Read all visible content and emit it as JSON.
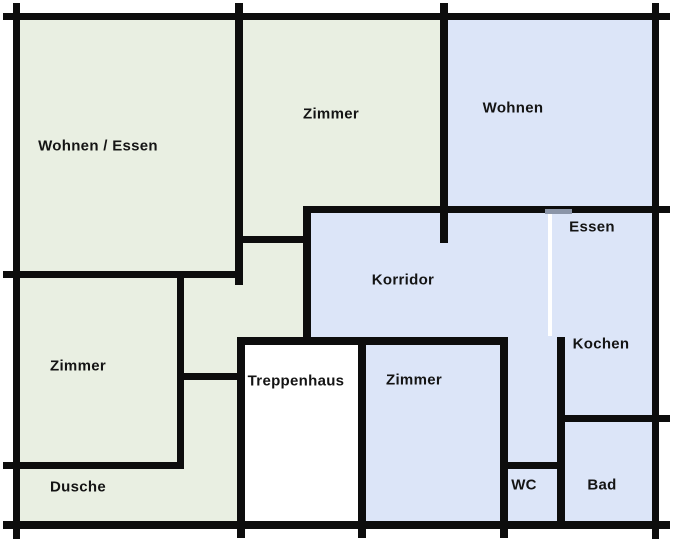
{
  "title": "Grundriss / floor plan",
  "colors": {
    "wall": "#0d0d0d",
    "apartment_green": "#e9efe2",
    "apartment_blue": "#dce5f8",
    "stairwell_white": "#ffffff",
    "door_gap_gray": "#8b95a8",
    "door_gap_white": "#ffffff",
    "label_text": "#141414",
    "page_background": "#ffffff"
  },
  "rooms": [
    {
      "id": "wohnen-essen",
      "label": "Wohnen / Essen",
      "apartment": "green",
      "cx": 98,
      "cy": 146
    },
    {
      "id": "zimmer-top",
      "label": "Zimmer",
      "apartment": "green",
      "cx": 331,
      "cy": 114
    },
    {
      "id": "wohnen",
      "label": "Wohnen",
      "apartment": "blue",
      "cx": 513,
      "cy": 108
    },
    {
      "id": "essen",
      "label": "Essen",
      "apartment": "blue",
      "cx": 592,
      "cy": 227
    },
    {
      "id": "korridor",
      "label": "Korridor",
      "apartment": "blue",
      "cx": 403,
      "cy": 280
    },
    {
      "id": "kochen",
      "label": "Kochen",
      "apartment": "blue",
      "cx": 601,
      "cy": 344
    },
    {
      "id": "zimmer-left",
      "label": "Zimmer",
      "apartment": "green",
      "cx": 78,
      "cy": 366
    },
    {
      "id": "treppenhaus",
      "label": "Treppenhaus",
      "apartment": "shared",
      "cx": 296,
      "cy": 381
    },
    {
      "id": "zimmer-bottom",
      "label": "Zimmer",
      "apartment": "blue",
      "cx": 414,
      "cy": 380
    },
    {
      "id": "dusche",
      "label": "Dusche",
      "apartment": "green",
      "cx": 78,
      "cy": 487
    },
    {
      "id": "wc",
      "label": "WC",
      "apartment": "blue",
      "cx": 524,
      "cy": 485
    },
    {
      "id": "bad",
      "label": "Bad",
      "apartment": "blue",
      "cx": 602,
      "cy": 485
    }
  ],
  "plan": {
    "width": 676,
    "height": 543,
    "regions": [
      {
        "fill": "apartment_green",
        "x": 16,
        "y": 16,
        "w": 295,
        "h": 329
      },
      {
        "fill": "apartment_green",
        "x": 16,
        "y": 345,
        "w": 221,
        "h": 180
      },
      {
        "fill": "apartment_green",
        "x": 311,
        "y": 16,
        "w": 137,
        "h": 197
      },
      {
        "fill": "apartment_blue",
        "x": 448,
        "y": 16,
        "w": 208,
        "h": 190
      },
      {
        "fill": "apartment_blue",
        "x": 311,
        "y": 206,
        "w": 345,
        "h": 139
      },
      {
        "fill": "apartment_blue",
        "x": 366,
        "y": 345,
        "w": 142,
        "h": 180
      },
      {
        "fill": "apartment_blue",
        "x": 508,
        "y": 345,
        "w": 148,
        "h": 180
      },
      {
        "fill": "stairwell_white",
        "x": 245,
        "y": 345,
        "w": 113,
        "h": 176
      }
    ],
    "walls": [
      {
        "name": "outer-top",
        "x": 3,
        "y": 13,
        "w": 667,
        "h": 7
      },
      {
        "name": "outer-bottom",
        "x": 3,
        "y": 521,
        "w": 667,
        "h": 8
      },
      {
        "name": "outer-left",
        "x": 13,
        "y": 3,
        "w": 7,
        "h": 536
      },
      {
        "name": "outer-right",
        "x": 652,
        "y": 3,
        "w": 7,
        "h": 536
      },
      {
        "name": "wohnen-essen-right",
        "x": 235,
        "y": 3,
        "w": 8,
        "h": 282
      },
      {
        "name": "zimmer-wohnen-div",
        "x": 440,
        "y": 3,
        "w": 8,
        "h": 240
      },
      {
        "name": "wohnen-essen-bottom",
        "x": 3,
        "y": 271,
        "w": 240,
        "h": 7
      },
      {
        "name": "vestibule-top",
        "x": 235,
        "y": 236,
        "w": 76,
        "h": 7
      },
      {
        "name": "korridor-left",
        "x": 303,
        "y": 206,
        "w": 8,
        "h": 139
      },
      {
        "name": "korridor-top",
        "x": 303,
        "y": 206,
        "w": 367,
        "h": 7
      },
      {
        "name": "zimmer-left-right",
        "x": 177,
        "y": 271,
        "w": 7,
        "h": 198
      },
      {
        "name": "hall-stub",
        "x": 177,
        "y": 373,
        "w": 68,
        "h": 7
      },
      {
        "name": "dusche-top",
        "x": 3,
        "y": 462,
        "w": 181,
        "h": 7
      },
      {
        "name": "korridor-bottom",
        "x": 237,
        "y": 337,
        "w": 271,
        "h": 8
      },
      {
        "name": "treppenhaus-left",
        "x": 237,
        "y": 340,
        "w": 8,
        "h": 198
      },
      {
        "name": "treppenhaus-right",
        "x": 358,
        "y": 340,
        "w": 8,
        "h": 198
      },
      {
        "name": "zimmer-bottom-right",
        "x": 500,
        "y": 340,
        "w": 8,
        "h": 198
      },
      {
        "name": "kochen-left",
        "x": 557,
        "y": 337,
        "w": 8,
        "h": 192
      },
      {
        "name": "bad-top",
        "x": 562,
        "y": 415,
        "w": 108,
        "h": 7
      },
      {
        "name": "wc-top",
        "x": 502,
        "y": 462,
        "w": 63,
        "h": 7
      }
    ],
    "door_marks": [
      {
        "name": "wohnen-essen-door",
        "fill": "door_gap_gray",
        "x": 545,
        "y": 209,
        "w": 27,
        "h": 5
      },
      {
        "name": "essen-korridor-opening",
        "fill": "door_gap_white",
        "x": 548,
        "y": 214,
        "w": 4,
        "h": 122
      }
    ]
  }
}
